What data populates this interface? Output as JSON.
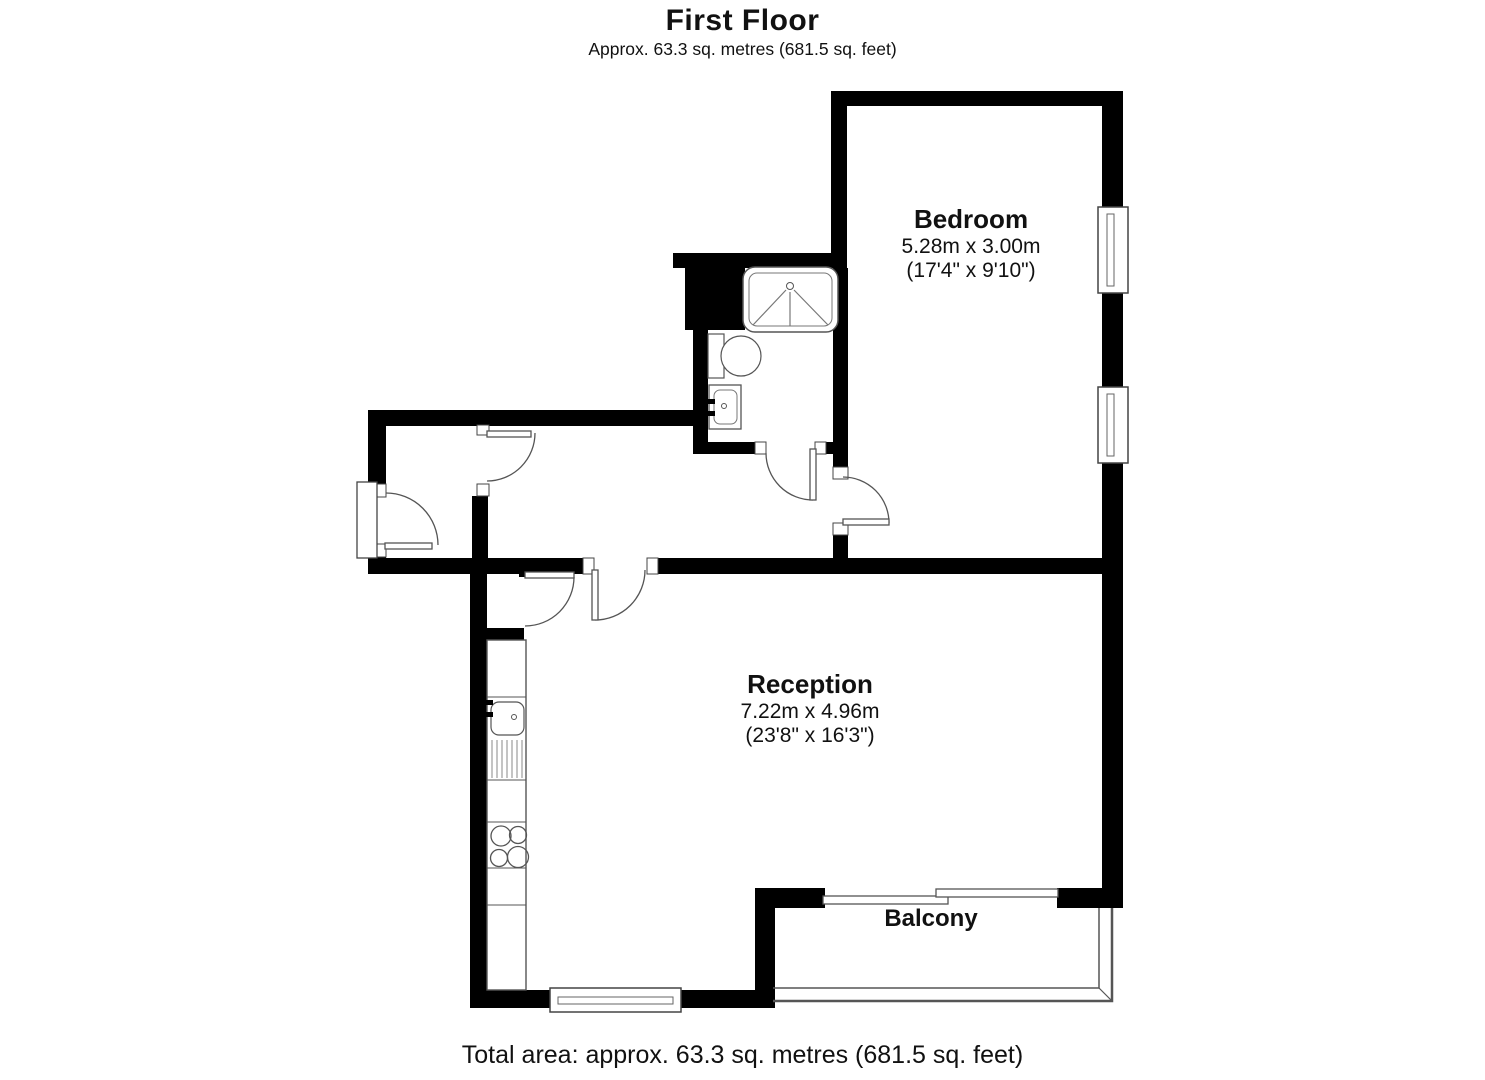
{
  "header": {
    "title": "First Floor",
    "subtitle": "Approx. 63.3 sq. metres (681.5 sq. feet)"
  },
  "rooms": {
    "bedroom": {
      "name": "Bedroom",
      "dims_m": "5.28m x 3.00m",
      "dims_ft": "(17'4\" x 9'10\")"
    },
    "reception": {
      "name": "Reception",
      "dims_m": "7.22m x 4.96m",
      "dims_ft": "(23'8\" x 16'3\")"
    },
    "balcony": {
      "name": "Balcony"
    }
  },
  "footer": {
    "total_area": "Total area: approx. 63.3 sq. metres (681.5 sq. feet)"
  },
  "colors": {
    "wall": "#000000",
    "line": "#555555",
    "background": "#ffffff"
  }
}
